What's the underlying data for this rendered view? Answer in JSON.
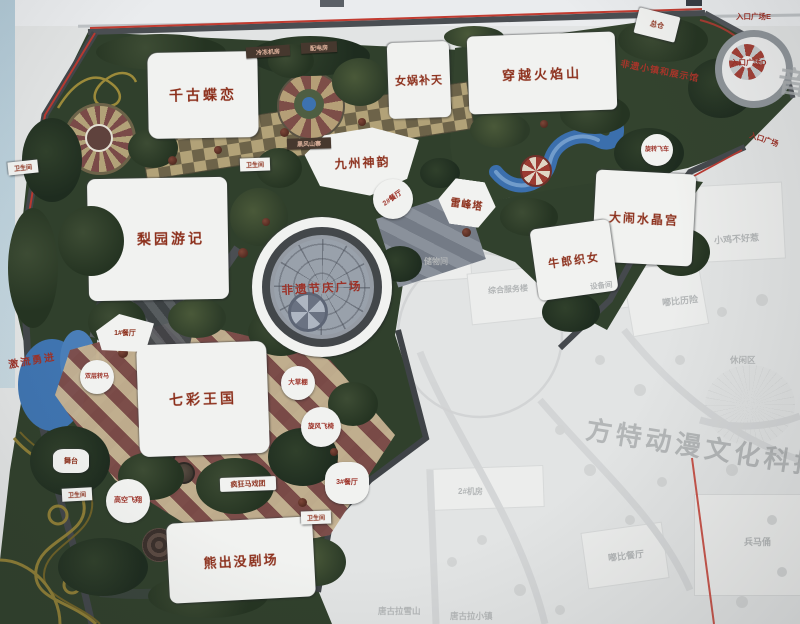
{
  "photo": {
    "watermark_text": "方特动漫文化科技",
    "edge_character": "音"
  },
  "map": {
    "attractions": [
      {
        "label": "千古蝶恋"
      },
      {
        "label": "女娲补天"
      },
      {
        "label": "穿越火焰山"
      },
      {
        "label": "九州神韵"
      },
      {
        "label": "雷峰塔"
      },
      {
        "label": "大闹水晶宫"
      },
      {
        "label": "牛郎织女"
      },
      {
        "label": "梨园游记"
      },
      {
        "label": "七彩王国"
      },
      {
        "label": "熊出没剧场"
      },
      {
        "label": "非遗节庆广场"
      }
    ],
    "facilities": [
      {
        "label": "总仓"
      },
      {
        "label": "1#餐厅"
      },
      {
        "label": "2#餐厅"
      },
      {
        "label": "3#餐厅"
      },
      {
        "label": "大草棚"
      },
      {
        "label": "旋风飞椅"
      },
      {
        "label": "高空飞翔"
      },
      {
        "label": "疯狂马戏团"
      },
      {
        "label": "舞台"
      },
      {
        "label": "双层转马"
      },
      {
        "label": "激流勇进"
      },
      {
        "label": "旋转飞车"
      },
      {
        "label": "冷冻机房"
      },
      {
        "label": "配电房"
      },
      {
        "label": "黑风山寨"
      },
      {
        "label": "非遗小镇和展示馆"
      },
      {
        "label": "入口广场E"
      },
      {
        "label": "入口广场D"
      },
      {
        "label": "入口广场"
      }
    ],
    "restroom_label": "卫生间",
    "faded_area_labels": [
      "储物间",
      "综合服务楼",
      "设备间",
      "小鸡不好惹",
      "嘟比历险",
      "休闲区",
      "嘟比餐厅",
      "兵马俑",
      "2#机房",
      "唐古拉雪山",
      "唐古拉小镇"
    ]
  },
  "colors": {
    "boundary_red": "#c23b30",
    "park_green": "#30402c",
    "water_blue": "#3b6fad",
    "label_red": "#8c2f1b"
  }
}
